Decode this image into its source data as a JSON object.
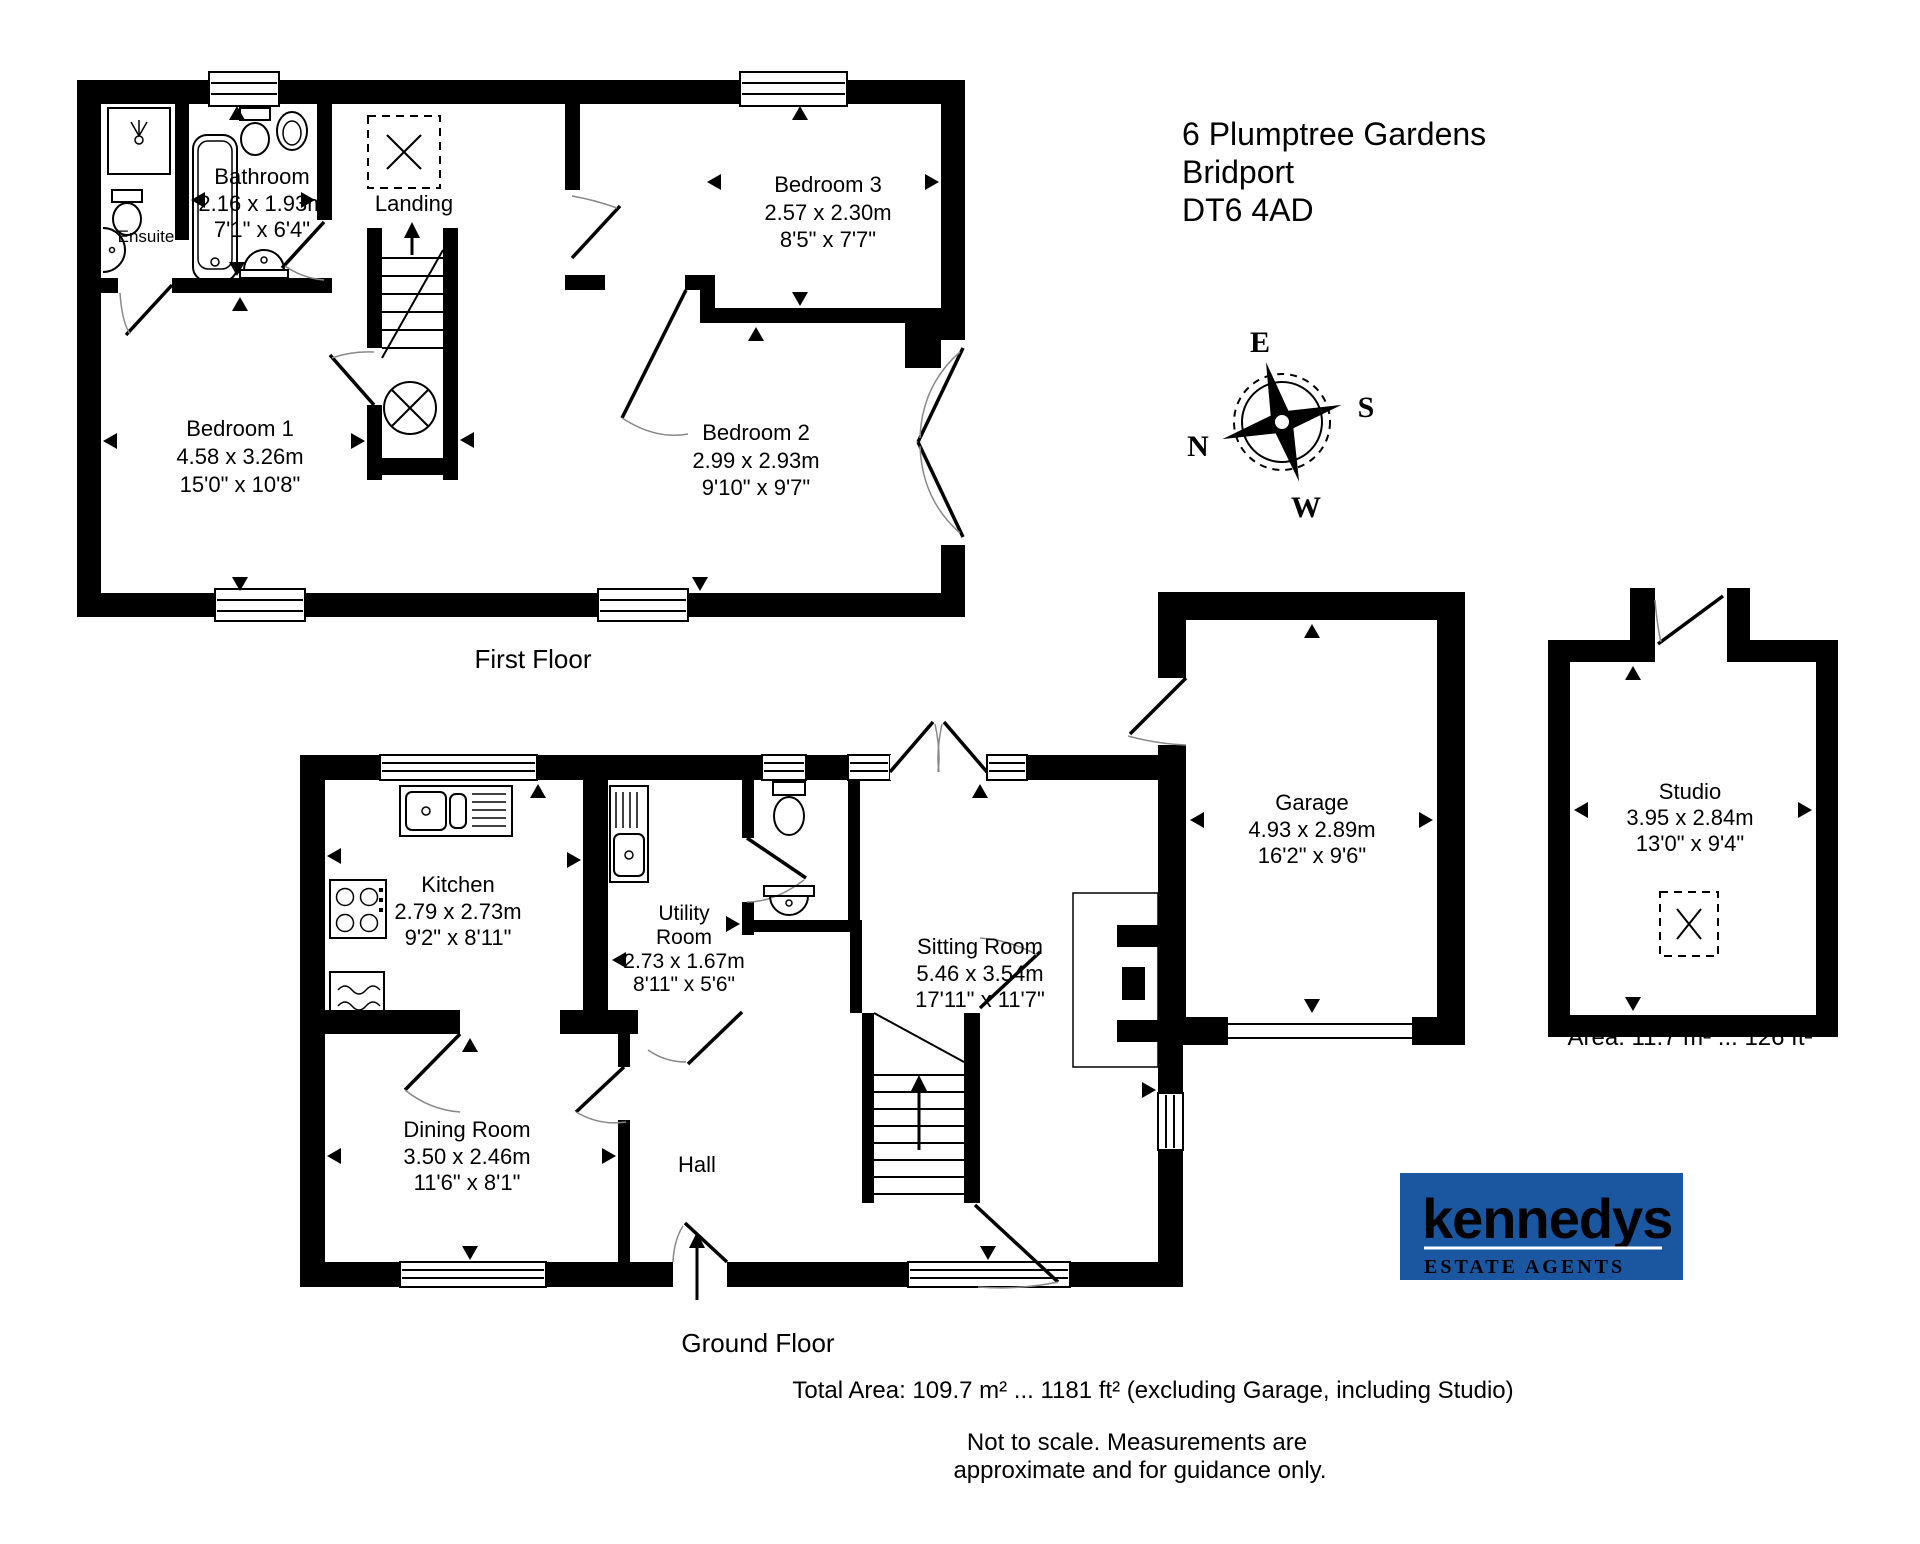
{
  "page": {
    "background": "#ffffff",
    "ink": "#000000"
  },
  "address": {
    "line1": "6 Plumptree Gardens",
    "line2": "Bridport",
    "line3": "DT6 4AD"
  },
  "compass": {
    "east": "E",
    "south": "S",
    "north": "N",
    "west": "W"
  },
  "floor_labels": {
    "first": "First Floor",
    "ground": "Ground Floor"
  },
  "rooms": {
    "ensuite": {
      "name": "Ensuite"
    },
    "bathroom": {
      "name": "Bathroom",
      "metric": "2.16 x 1.93m",
      "imperial": "7'1\" x 6'4\""
    },
    "landing": {
      "name": "Landing"
    },
    "bedroom1": {
      "name": "Bedroom 1",
      "metric": "4.58 x 3.26m",
      "imperial": "15'0\" x 10'8\""
    },
    "bedroom2": {
      "name": "Bedroom 2",
      "metric": "2.99 x 2.93m",
      "imperial": "9'10\" x 9'7\""
    },
    "bedroom3": {
      "name": "Bedroom 3",
      "metric": "2.57 x 2.30m",
      "imperial": "8'5\" x 7'7\""
    },
    "kitchen": {
      "name": "Kitchen",
      "metric": "2.79 x 2.73m",
      "imperial": "9'2\" x 8'11\""
    },
    "utility": {
      "name_line1": "Utility",
      "name_line2": "Room",
      "metric": "2.73 x 1.67m",
      "imperial": "8'11\" x 5'6\""
    },
    "dining": {
      "name": "Dining Room",
      "metric": "3.50 x 2.46m",
      "imperial": "11'6\" x 8'1\""
    },
    "hall": {
      "name": "Hall"
    },
    "sitting": {
      "name": "Sitting Room",
      "metric": "5.46 x 3.54m",
      "imperial": "17'11\" x 11'7\""
    },
    "garage": {
      "name": "Garage",
      "metric": "4.93 x 2.89m",
      "imperial": "16'2\" x 9'6\""
    },
    "studio": {
      "name": "Studio",
      "metric": "3.95 x 2.84m",
      "imperial": "13'0\" x 9'4\"",
      "area": "Area: 11.7 m² ... 126 ft²"
    }
  },
  "footer": {
    "total_area": "Total Area: 109.7 m² ... 1181 ft² (excluding Garage, including Studio)",
    "disclaimer_line1": "Not to scale. Measurements are",
    "disclaimer_line2": "approximate and for guidance only."
  },
  "logo": {
    "brand": "kennedys",
    "tagline": "ESTATE AGENTS",
    "background": "#1a57a0",
    "text_color": "#ffffff"
  }
}
